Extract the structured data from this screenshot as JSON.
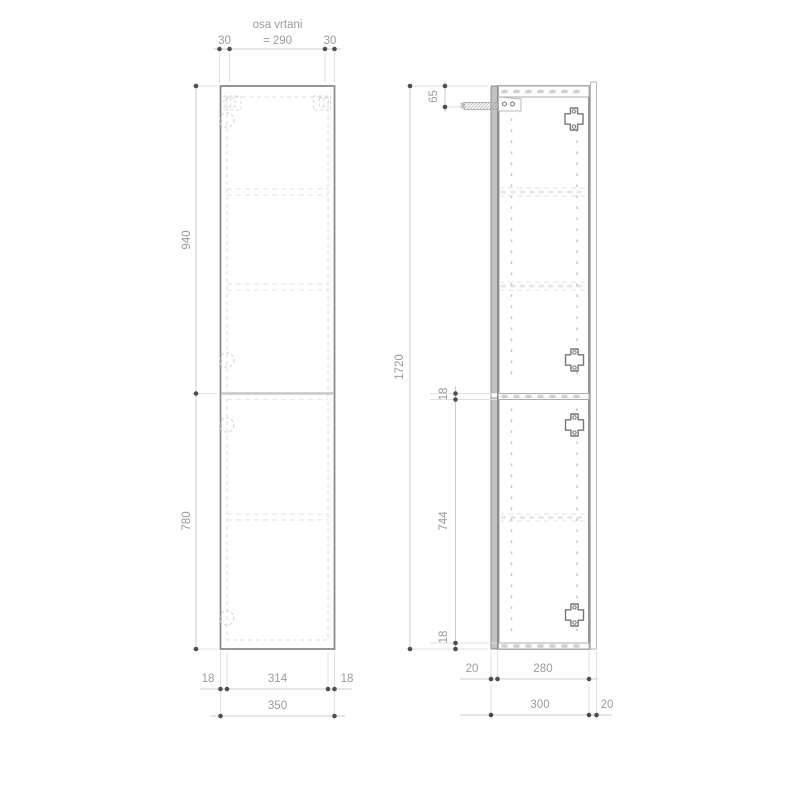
{
  "front_view": {
    "drill_axis_label": "osa vrtani",
    "drill_axis_value": "= 290",
    "drill_offset_left": "30",
    "drill_offset_right": "30",
    "upper_door_height": "940",
    "lower_door_height": "780",
    "side_panel_left": "18",
    "inner_width": "314",
    "side_panel_right": "18",
    "total_width": "350"
  },
  "side_view": {
    "total_height": "1720",
    "bracket_offset": "65",
    "divider_thickness": "18",
    "lower_section_height": "744",
    "bottom_panel_thickness": "18",
    "door_thickness": "20",
    "body_depth": "280",
    "total_depth": "300",
    "back_rail_depth": "20"
  }
}
